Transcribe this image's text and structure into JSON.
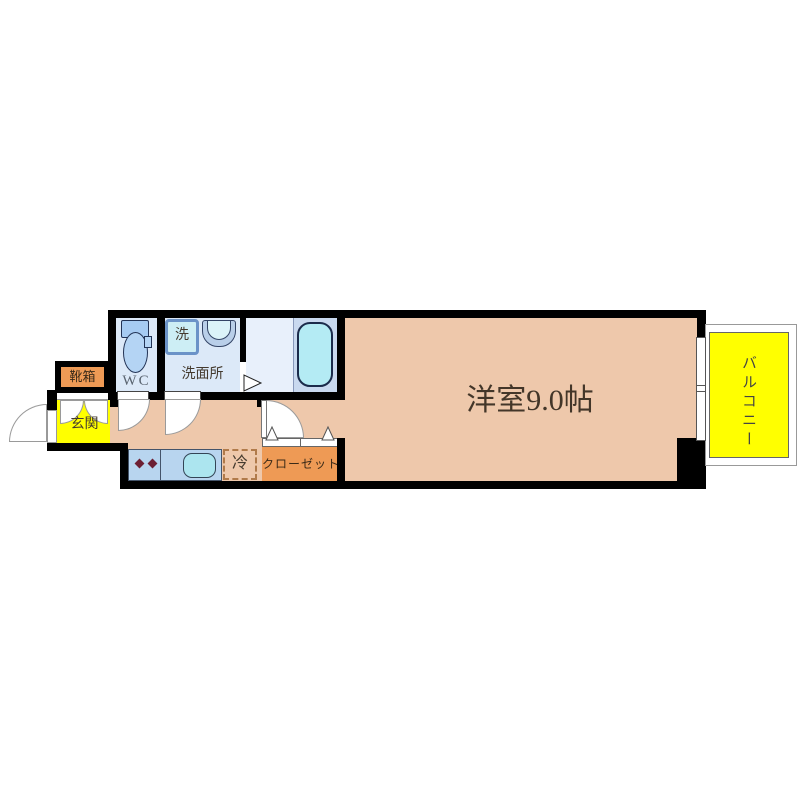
{
  "floorplan": {
    "rooms": {
      "entrance": {
        "label": "玄関"
      },
      "shoe_box": {
        "label": "靴箱"
      },
      "toilet": {
        "label": "WC"
      },
      "washer": {
        "label": "洗"
      },
      "washroom": {
        "label": "洗面所"
      },
      "refrigerator": {
        "label": "冷"
      },
      "closet": {
        "label": "クローゼット"
      },
      "main_room": {
        "label": "洋室9.0帖"
      },
      "balcony": {
        "label": "バルコニー"
      }
    },
    "fixtures": [
      "toilet-icon",
      "washing-machine-icon",
      "basin-icon",
      "bathtub-icon",
      "stove-burners-icon",
      "kitchen-sink-icon",
      "door-swing-icon",
      "folding-door-triangle-icon",
      "sliding-window-icon"
    ],
    "colors": {
      "wall": "#000000",
      "room_floor": "#eec8ab",
      "entrance_yellow": "#ffff00",
      "balcony_yellow": "#ffff00",
      "cabinet_orange": "#ee9a55",
      "wet_floor_blue": "#dce9f8",
      "bath_zone_blue": "#c9d9ef",
      "counter_blue": "#b8d5ef",
      "tub_cyan": "#b4ebf4",
      "sink_cyan": "#ace5ef"
    }
  }
}
